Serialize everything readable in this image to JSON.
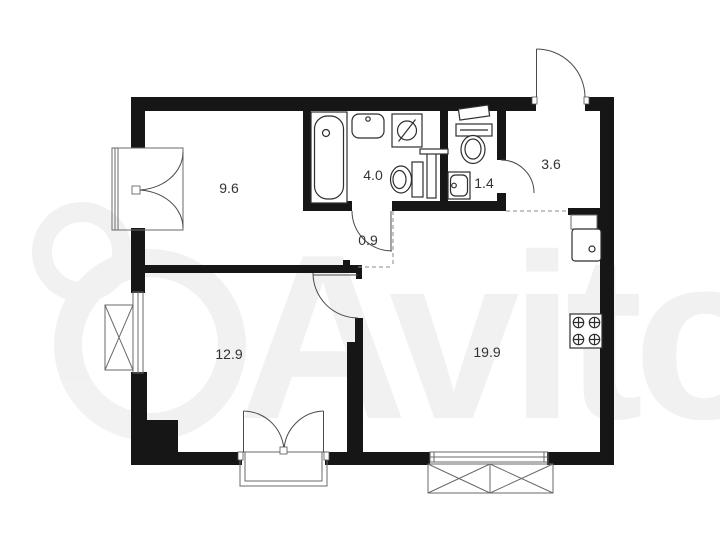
{
  "plan": {
    "watermark": "Avito",
    "rooms": [
      {
        "id": "bedroom-top-left",
        "label": "9.6"
      },
      {
        "id": "bathroom",
        "label": "4.0"
      },
      {
        "id": "wc",
        "label": "1.4"
      },
      {
        "id": "hallway",
        "label": "3.6"
      },
      {
        "id": "corridor",
        "label": "0.9"
      },
      {
        "id": "bedroom-bottom-left",
        "label": "12.9"
      },
      {
        "id": "kitchen-living-room",
        "label": "19.9"
      }
    ],
    "fixtures": [
      "bathtub",
      "bathroom-sink",
      "washing-machine",
      "toilet",
      "wc-toilet",
      "wc-sink",
      "kitchen-sink",
      "stove"
    ],
    "colors": {
      "wall": "#161616",
      "door_line": "#4a4a4a",
      "fixture_line": "#2e2e2e",
      "label_text": "#333333",
      "dashed_line": "#8a8a8a",
      "background": "#ffffff"
    }
  }
}
